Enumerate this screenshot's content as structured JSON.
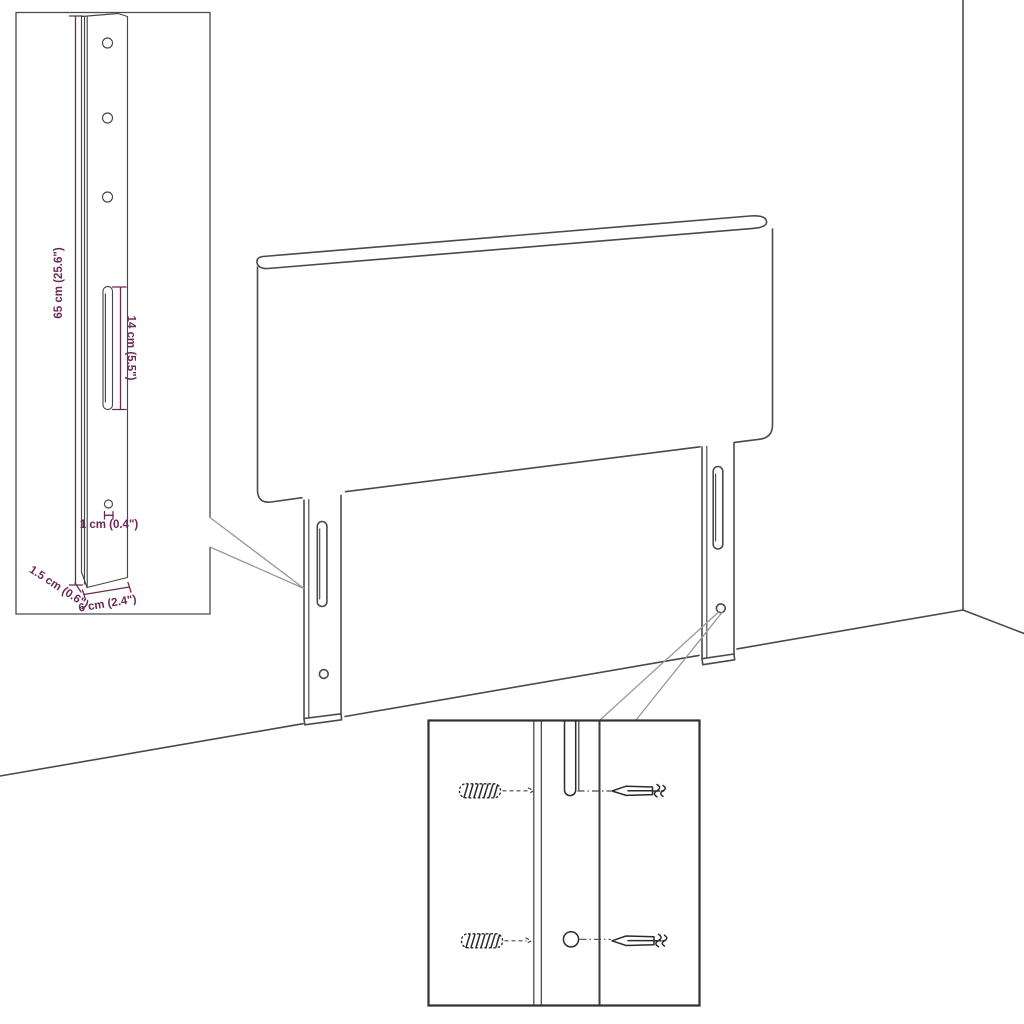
{
  "diagram": {
    "description": "Line-art assembly diagram of a headboard with two mounting legs, a magnified mounting-bracket detail with dimensions, and a magnified wall-fixing detail showing wall plugs and screws",
    "background": "#ffffff"
  },
  "colors": {
    "dimension": "#6b2956",
    "line": "#4a4a4a",
    "leader": "#9a9a9a",
    "hardware": "#2b2b2b",
    "background": "#ffffff"
  },
  "bracket_inset": {
    "dimensions": {
      "height": "65 cm (25.6\")",
      "slot_length": "14 cm (5.5\")",
      "hole_diameter": "1 cm (0.4\")",
      "thickness": "1.5 cm (0.6\")",
      "width": "6 cm (2.4\")"
    }
  },
  "hardware_inset": {
    "items": [
      "wall-plug",
      "screw",
      "mounting-slot",
      "mounting-hole"
    ]
  }
}
